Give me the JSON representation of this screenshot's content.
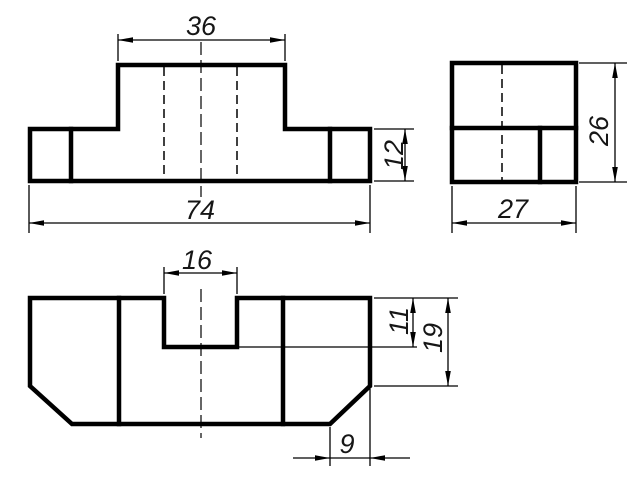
{
  "drawing": {
    "background": "#ffffff",
    "line_color": "#000000",
    "text_color": "#161616",
    "views": {
      "front": {
        "dims": {
          "boss_width": "36",
          "total_width": "74",
          "base_height": "12"
        }
      },
      "side": {
        "dims": {
          "total_height": "26",
          "depth": "27"
        }
      },
      "top": {
        "dims": {
          "slot_width": "16",
          "slot_depth": "11",
          "depth_to_chamfer": "19",
          "chamfer_width": "9"
        }
      }
    }
  }
}
